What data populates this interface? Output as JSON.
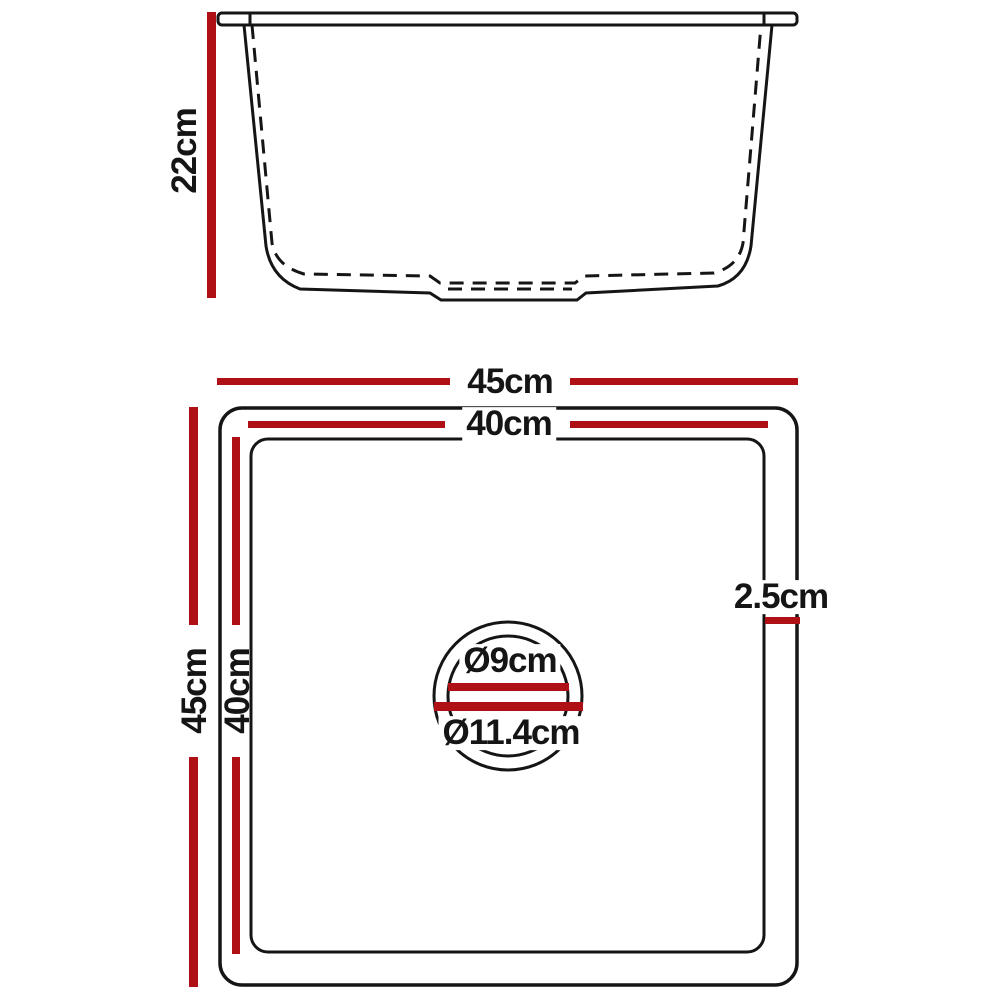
{
  "colors": {
    "accent": "#ae1016",
    "line": "#151515",
    "background": "#ffffff"
  },
  "side_view": {
    "height_label": "22cm"
  },
  "top_view": {
    "outer_width_label": "45cm",
    "inner_width_label": "40cm",
    "outer_height_label": "45cm",
    "inner_height_label": "40cm",
    "rim_width_label": "2.5cm",
    "drain_inner_label": "Ø9cm",
    "drain_outer_label": "Ø11.4cm"
  }
}
